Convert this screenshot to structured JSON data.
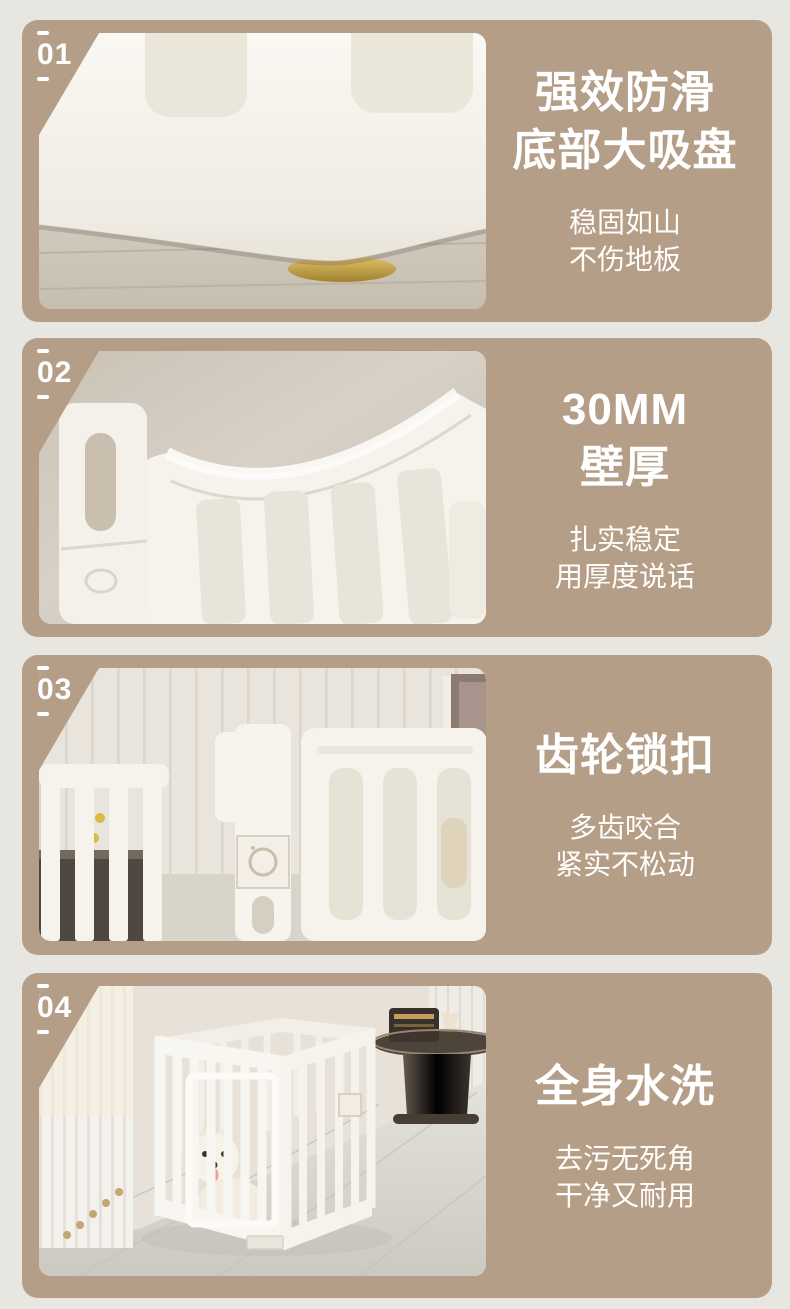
{
  "page": {
    "background_color": "#e8e6e1",
    "card_color": "#b49e87",
    "text_color": "#ffffff",
    "gold_accent_color": "#c2a14d"
  },
  "sections": [
    {
      "number": "01",
      "title_lines": [
        "强效防滑",
        "底部大吸盘"
      ],
      "subtitle_lines": [
        "稳固如山",
        "不伤地板"
      ],
      "photo": "close-up of white playpen base on wood floor with gold suction cup"
    },
    {
      "number": "02",
      "title_lines": [
        "30MM",
        "壁厚"
      ],
      "subtitle_lines": [
        "扎实稳定",
        "用厚度说话"
      ],
      "photo": "close-up of thick white fence panel corner joint"
    },
    {
      "number": "03",
      "title_lines": [
        "齿轮锁扣"
      ],
      "subtitle_lines": [
        "多齿咬合",
        "紧实不松动"
      ],
      "photo": "fence panels with gear lock connector in room"
    },
    {
      "number": "04",
      "title_lines": [
        "全身水洗"
      ],
      "subtitle_lines": [
        "去污无死角",
        "干净又耐用"
      ],
      "photo": "full white pet playpen with dog inside, curtain and side table"
    }
  ]
}
